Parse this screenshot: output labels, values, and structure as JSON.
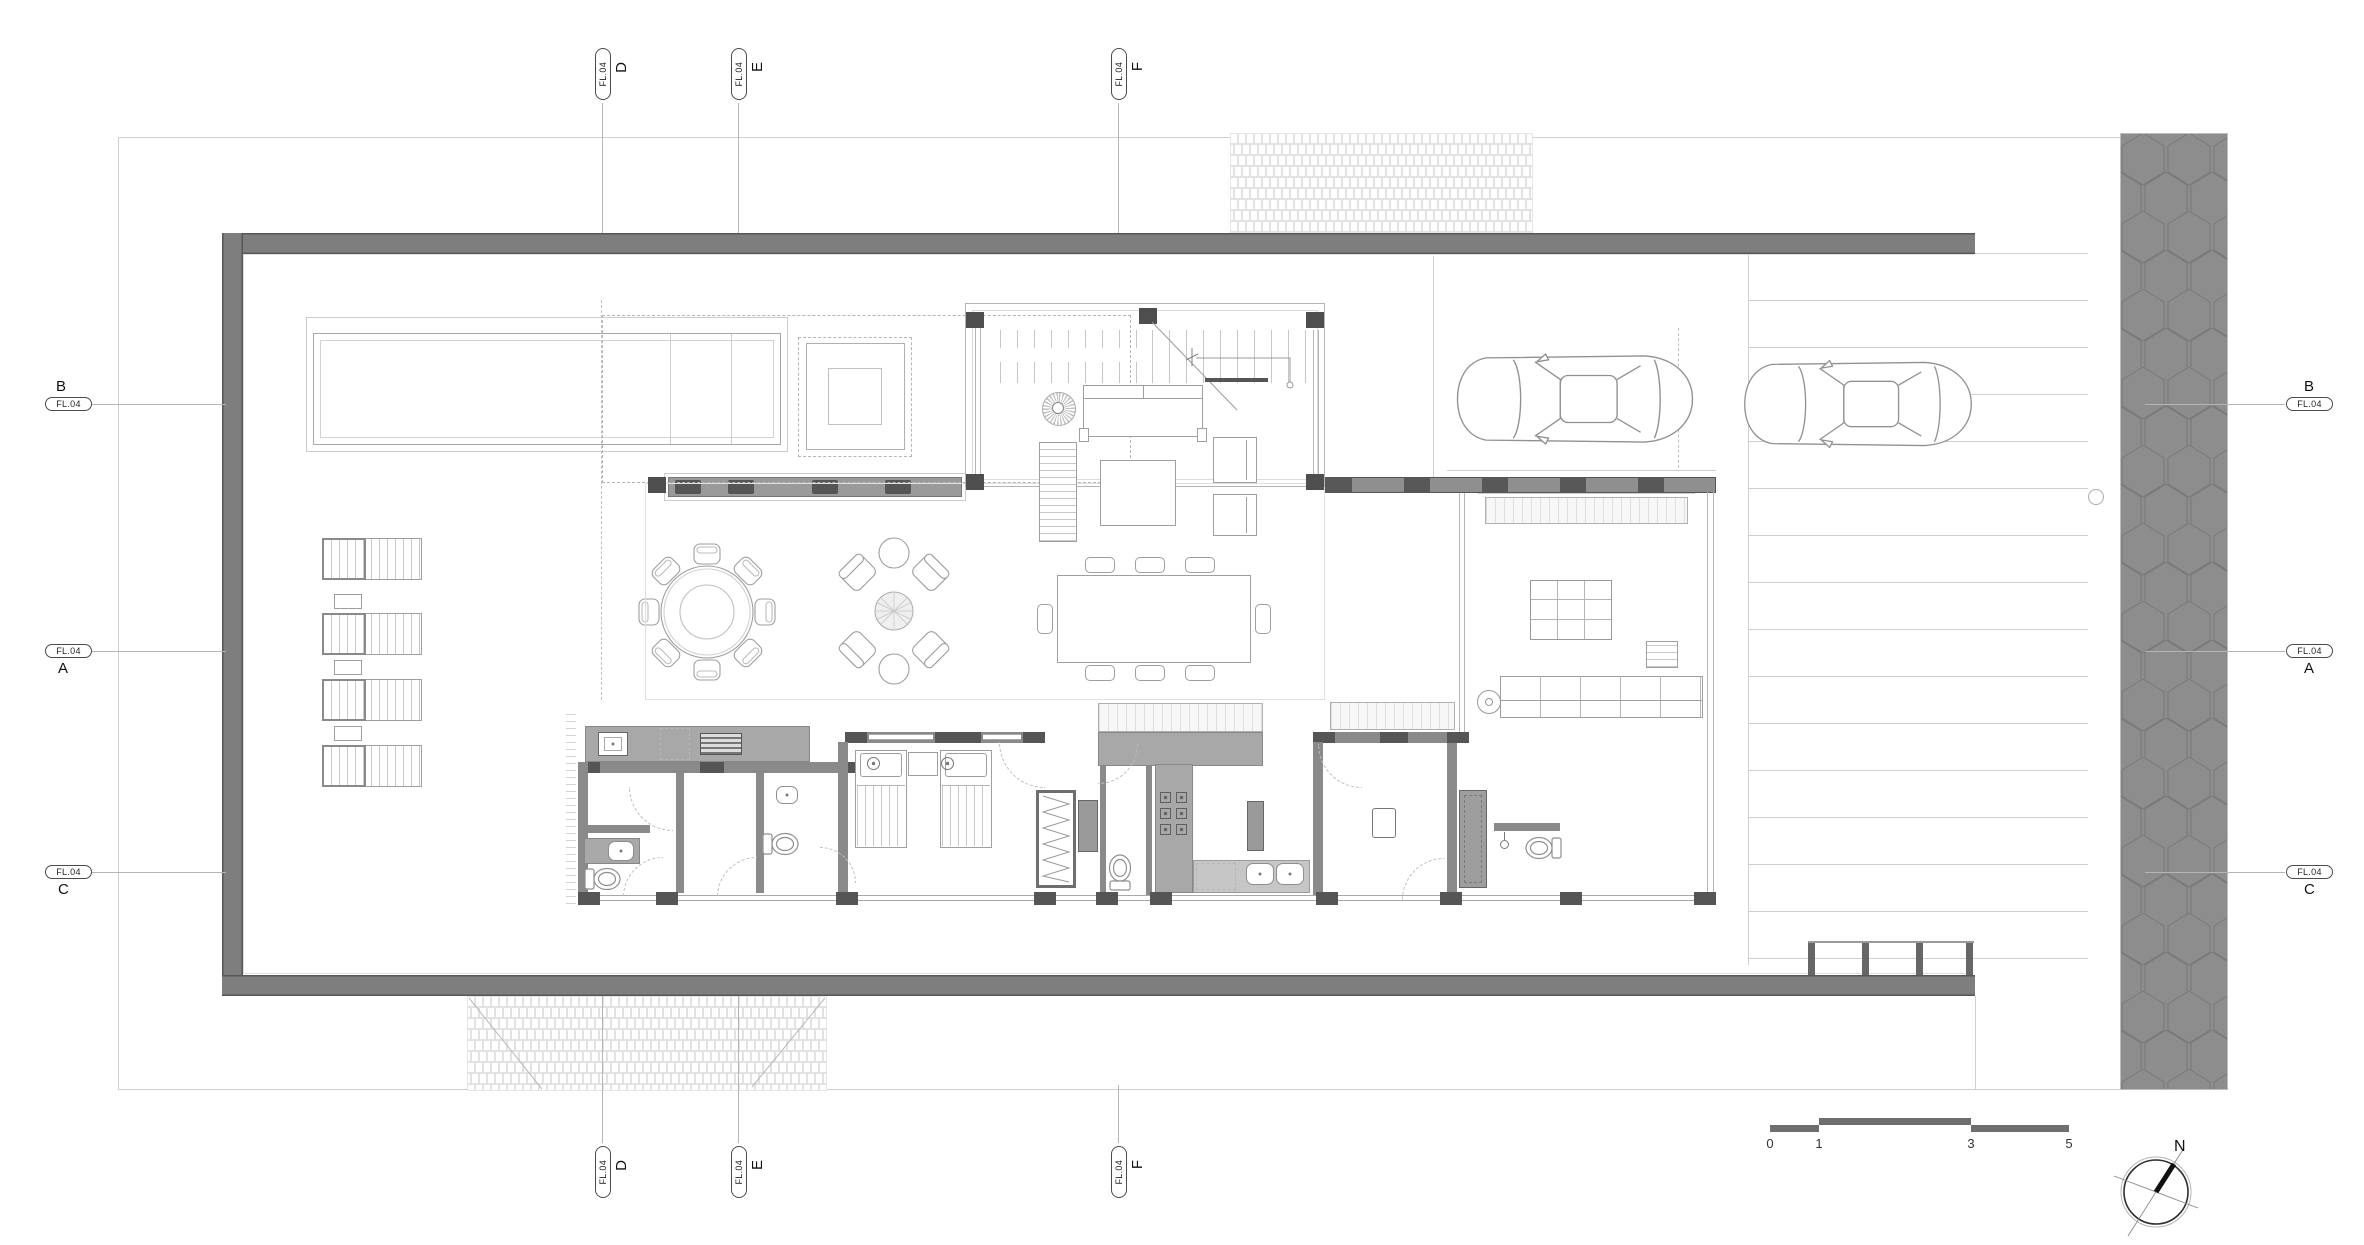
{
  "document": {
    "type": "architectural-floor-plan",
    "sheet_level_tag": "FL.04"
  },
  "grid": {
    "top": [
      {
        "letter": "D",
        "tag": "FL.04"
      },
      {
        "letter": "E",
        "tag": "FL.04"
      },
      {
        "letter": "F",
        "tag": "FL.04"
      }
    ],
    "bottom": [
      {
        "letter": "D",
        "tag": "FL.04"
      },
      {
        "letter": "E",
        "tag": "FL.04"
      },
      {
        "letter": "F",
        "tag": "FL.04"
      }
    ],
    "left": [
      {
        "letter": "B",
        "tag": "FL.04"
      },
      {
        "letter": "A",
        "tag": "FL.04"
      },
      {
        "letter": "C",
        "tag": "FL.04"
      }
    ],
    "right": [
      {
        "letter": "B",
        "tag": "FL.04"
      },
      {
        "letter": "A",
        "tag": "FL.04"
      },
      {
        "letter": "C",
        "tag": "FL.04"
      }
    ]
  },
  "scale_bar": {
    "labels": [
      "0",
      "1",
      "3",
      "5"
    ]
  },
  "north": {
    "label": "N"
  },
  "colors": {
    "background": "#ffffff",
    "boundary_wall": "#7e7e7e",
    "interior_wall": "#8a8a8a",
    "column": "#4e4e4e",
    "road_paving": "#8d8d8d",
    "counter": "#a8a8a8",
    "drawing_line": "#9a9a9a",
    "hatch_line": "#e2e2e2",
    "scale_bar": "#6e6e6e"
  },
  "plan_elements": {
    "rooms": [
      "pool",
      "spa",
      "outdoor-lounge",
      "sun-deck",
      "outdoor-dining",
      "living-room",
      "stair",
      "dining-room",
      "kitchen",
      "bedroom",
      "closet",
      "wc",
      "maid-room",
      "storage",
      "service-bathroom",
      "hallway",
      "family-room",
      "wardrobe",
      "master-bathroom",
      "carport",
      "driveway",
      "entry-court"
    ],
    "furniture": [
      "sun-lounger",
      "side-table",
      "round-dining-table",
      "dining-chair",
      "armchair",
      "coffee-table",
      "sofa",
      "rug",
      "twin-bed",
      "nightstand",
      "toilet",
      "washbasin",
      "cooktop",
      "kitchen-sink",
      "grill",
      "refrigerator",
      "grid-table",
      "bench"
    ],
    "vehicles": [
      "car",
      "car"
    ]
  }
}
